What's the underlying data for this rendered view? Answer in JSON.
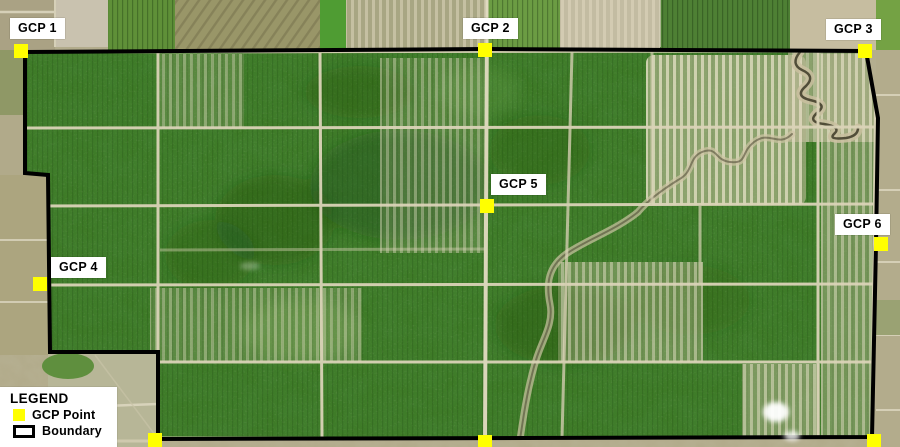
{
  "gcps": [
    {
      "label": "GCP 1"
    },
    {
      "label": "GCP 2"
    },
    {
      "label": "GCP 3"
    },
    {
      "label": "GCP 4"
    },
    {
      "label": "GCP 5"
    },
    {
      "label": "GCP 6"
    }
  ],
  "gcp_marker_total": 9,
  "legend": {
    "title": "LEGEND",
    "items": [
      {
        "label": "GCP Point",
        "swatch_color": "#FFFF00"
      },
      {
        "label": "Boundary",
        "swatch_color": "#000000"
      }
    ]
  },
  "colors": {
    "gcp_marker": "#FFFF00",
    "boundary_line": "#000000",
    "label_background": "#FFFFFF",
    "label_text": "#000000"
  }
}
